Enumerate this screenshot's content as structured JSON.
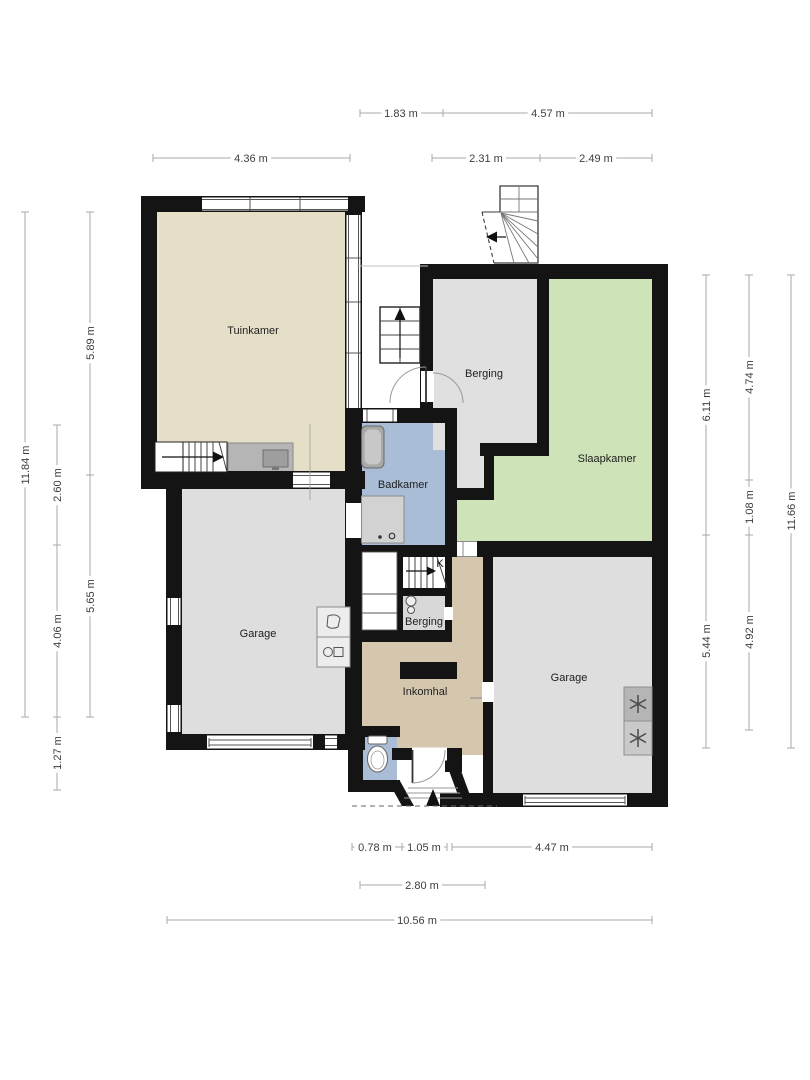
{
  "rooms": {
    "tuinkamer": "Tuinkamer",
    "berging_top": "Berging",
    "slaapkamer": "Slaapkamer",
    "badkamer": "Badkamer",
    "garage_left": "Garage",
    "berging_small": "Berging",
    "inkomhal": "Inkomhal",
    "garage_right": "Garage",
    "cellar_stair": "K"
  },
  "dimensions": {
    "top": [
      "1.83 m",
      "4.57 m",
      "4.36 m",
      "2.31 m",
      "2.49 m"
    ],
    "left": [
      "11.84 m",
      "5.89 m",
      "5.65 m",
      "2.60 m",
      "4.06 m",
      "1.27 m"
    ],
    "right": [
      "6.11 m",
      "5.44 m",
      "4.74 m",
      "1.08 m",
      "4.92 m",
      "11.66 m"
    ],
    "bottom": [
      "0.78 m",
      "1.05 m",
      "4.47 m",
      "2.80 m",
      "10.56 m"
    ]
  },
  "colors": {
    "wall": "#141414",
    "tuinkamer": "#e6dfc8",
    "garage": "#dedede",
    "berging_top": "#e0e0e0",
    "slaapkamer": "#cfe3b8",
    "badkamer": "#aabdd6",
    "toilet": "#aabdd6",
    "inkomhal": "#d5c6ae",
    "berging_small": "#d8d8d8",
    "appliance": "#b5b5b5",
    "cabinet": "#b5b5b5",
    "dim_line": "#a9a9a9",
    "dim_text": "#3d3d3d"
  },
  "icons": {
    "stair_up_arrow": "arrow-up",
    "stair_down_arrow": "arrow-right",
    "entrance_arrow": "arrow-up",
    "exterior_stair_arrow": "arrow-left",
    "ventilation": "asterisk"
  }
}
